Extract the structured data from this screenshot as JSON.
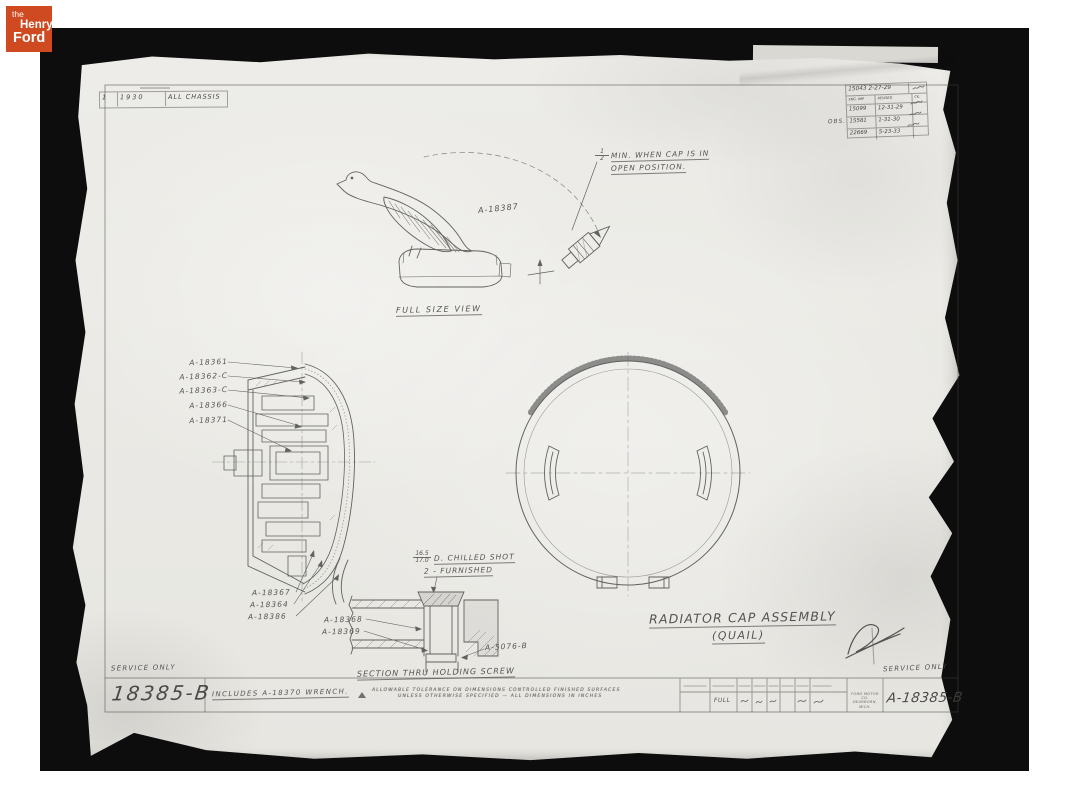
{
  "colors": {
    "logo_red": "#cf4a20",
    "paper": "#edece8",
    "frame_black": "#0d0d0d",
    "pencil": "#4a4a4a"
  },
  "logo": {
    "word_the": "the",
    "word_henry": "Henry",
    "word_ford": "Ford"
  },
  "top_table": {
    "index": "1",
    "year": "1930",
    "scope": "ALL CHASSIS"
  },
  "revision_table": {
    "release_number": "15043",
    "release_date": "2-27-29",
    "header_eng": "ENG. IMP",
    "header_revised": "REVISED",
    "header_ck": "CK.",
    "obs_prefix": "OBS.",
    "rows": [
      {
        "number": "15099",
        "date": "12-31-29"
      },
      {
        "number": "15581",
        "date": "1-31-30"
      },
      {
        "number": "22669",
        "date": "5-23-33"
      }
    ]
  },
  "quail_view": {
    "part_label": "A-18387",
    "fraction_top": "1",
    "fraction_bottom": "2",
    "note_line1": "MIN. WHEN CAP IS IN",
    "note_line2": "OPEN POSITION.",
    "caption": "FULL SIZE VIEW"
  },
  "section_view": {
    "labels_left": [
      "A-18361",
      "A-18362-C",
      "A-18363-C",
      "A-18366",
      "A-18371"
    ],
    "labels_bottom": [
      "A-18367",
      "A-18364",
      "A-18386"
    ]
  },
  "screw_detail": {
    "fraction_top": "16.5",
    "fraction_bottom": "17.0",
    "note_line1": "D. CHILLED SHOT",
    "note_line2": "2 - FURNISHED",
    "label_a": "A-18368",
    "label_b": "A-18369",
    "label_right": "A-5076-B",
    "caption": "SECTION THRU HOLDING SCREW"
  },
  "title": {
    "line1": "RADIATOR CAP ASSEMBLY",
    "line2": "(QUAIL)"
  },
  "bottom_strip": {
    "service_only_left": "SERVICE ONLY",
    "number_left": "18385-B",
    "includes_note": "INCLUDES A-18370 WRENCH.",
    "fine_print_line1": "ALLOWABLE TOLERANCE ON DIMENSIONS CONTROLLED FINISHED SURFACES",
    "fine_print_line2": "UNLESS OTHERWISE SPECIFIED — ALL DIMENSIONS IN INCHES",
    "scale_value": "FULL",
    "company_line1": "FORD MOTOR CO.",
    "company_line2": "DEARBORN, MICH.",
    "number_right": "A-18385-B",
    "service_only_right": "SERVICE ONLY"
  }
}
